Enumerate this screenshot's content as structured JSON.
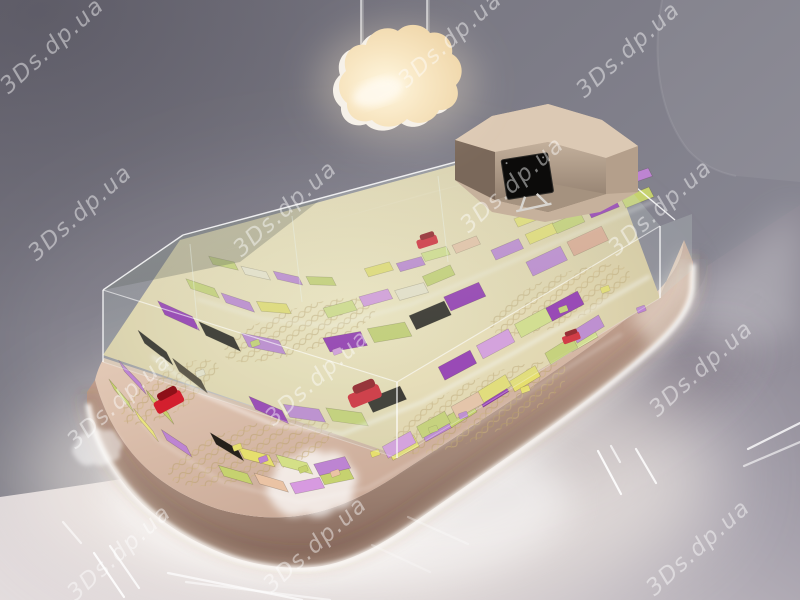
{
  "scene": {
    "kind": "3d-render-retail-island-display-kiosk",
    "watermark": {
      "text": "3Ds.dp.ua",
      "angle": -42,
      "positions": [
        [
          57,
          51
        ],
        [
          455,
          45
        ],
        [
          633,
          55
        ],
        [
          85,
          218
        ],
        [
          290,
          214
        ],
        [
          517,
          190
        ],
        [
          665,
          213
        ],
        [
          124,
          406
        ],
        [
          322,
          383
        ],
        [
          706,
          374
        ],
        [
          124,
          558
        ],
        [
          320,
          550
        ],
        [
          703,
          553
        ]
      ]
    },
    "colors": {
      "wall_dark": "#716f7a",
      "wall_light": "#8f8e9a",
      "floor_light": "#e3dcdd",
      "floor_dark": "#8b8793",
      "floor_glow": "#fff8ef",
      "base_light": "#d3b19e",
      "base_dark": "#87695c",
      "base_top": "#e8d2c0",
      "led_strip": "#ffffff",
      "glass_edge": "rgba(255,255,255,0.8)",
      "interior_glow": "#f6ecc4",
      "lattice_gold": "#cdb47c",
      "lamp_face": "#f2dcb6",
      "lamp_rim": "#f6f1e9",
      "monitor_screen": "#0c0b0a",
      "cloud_logo": "#ffffff",
      "watermark_color": "rgba(255,255,255,0.45)",
      "accent_red": "#d31f2e",
      "accent_red_dark": "#8e1018"
    },
    "lamp": {
      "icon": "cloud-pendant-lamp",
      "rod_count": 2
    },
    "logo": {
      "icon": "cloud-logo"
    },
    "cashier": {
      "monitor": "black-lcd-monitor"
    },
    "display": {
      "palette": {
        "lime": "#c6d26f",
        "lime2": "#d4e087",
        "yellow": "#e6df6e",
        "violet": "#bd84d2",
        "magenta": "#d79ae0",
        "purple": "#9130b2",
        "pink": "#eac3a4",
        "salmon": "#dfa88e",
        "black": "#26211b",
        "brown": "#473b2d",
        "cream": "#ece5cc"
      },
      "bands": [
        {
          "w": 30,
          "d": 13,
          "path": [
            [
              116,
              390
            ],
            [
              152,
              432
            ],
            [
              212,
              472
            ],
            [
              288,
              494
            ],
            [
              356,
              480
            ],
            [
              448,
              430
            ],
            [
              542,
              372
            ],
            [
              618,
              328
            ]
          ],
          "colors": [
            "lime",
            "yellow",
            "violet",
            null,
            "lime",
            "pink",
            "magenta",
            "lime",
            null,
            "yellow",
            "violet",
            "lime",
            "purple",
            "yellow",
            null,
            "lime2",
            "violet"
          ]
        },
        {
          "w": 32,
          "d": 14,
          "path": [
            [
              126,
              372
            ],
            [
              166,
              414
            ],
            [
              236,
              456
            ],
            [
              312,
              476
            ],
            [
              386,
              458
            ],
            [
              476,
              408
            ],
            [
              566,
              352
            ],
            [
              634,
              310
            ]
          ],
          "colors": [
            "violet",
            "lime",
            null,
            "black",
            "yellow",
            "lime2",
            "violet",
            null,
            "magenta",
            "lime",
            "pink",
            "yellow",
            null,
            "lime",
            "violet",
            "lime"
          ]
        },
        {
          "w": 36,
          "d": 16,
          "path": [
            [
              146,
              344
            ],
            [
              198,
              384
            ],
            [
              268,
              414
            ],
            [
              340,
              424
            ],
            [
              420,
              392
            ],
            [
              510,
              344
            ],
            [
              592,
              300
            ],
            [
              650,
              268
            ]
          ],
          "colors": [
            "black",
            "brown",
            null,
            "purple",
            "violet",
            "lime",
            "black",
            null,
            "purple",
            "magenta",
            "lime2",
            "purple",
            null,
            "black",
            "violet"
          ]
        },
        {
          "w": 38,
          "d": 17,
          "path": [
            [
              166,
              316
            ],
            [
              228,
              344
            ],
            [
              298,
              358
            ],
            [
              378,
              344
            ],
            [
              468,
              306
            ],
            [
              558,
              264
            ],
            [
              636,
              228
            ]
          ],
          "colors": [
            "purple",
            "black",
            "violet",
            null,
            "purple",
            "lime",
            "black",
            "purple",
            null,
            "violet",
            "salmon",
            "black",
            null,
            "purple"
          ]
        },
        {
          "w": 30,
          "d": 12,
          "path": [
            [
              192,
              290
            ],
            [
              258,
              312
            ],
            [
              330,
              318
            ],
            [
              410,
              296
            ],
            [
              500,
              258
            ],
            [
              584,
              222
            ],
            [
              654,
              194
            ]
          ],
          "colors": [
            "lime",
            "violet",
            "yellow",
            null,
            "lime2",
            "magenta",
            "cream",
            "lime",
            null,
            "violet",
            "yellow",
            "lime",
            "purple"
          ]
        },
        {
          "w": 26,
          "d": 10,
          "path": [
            [
              214,
              266
            ],
            [
              284,
              282
            ],
            [
              350,
              284
            ],
            [
              430,
              262
            ],
            [
              518,
              228
            ],
            [
              598,
              196
            ],
            [
              656,
              176
            ]
          ],
          "colors": [
            "lime",
            "cream",
            "violet",
            "lime",
            null,
            "yellow",
            "violet",
            "lime2",
            "pink",
            null,
            "yellow",
            "lime"
          ]
        }
      ],
      "chocolates": [
        [
          232,
          446,
          "yellow"
        ],
        [
          258,
          458,
          "violet"
        ],
        [
          298,
          468,
          "lime"
        ],
        [
          330,
          472,
          "pink"
        ],
        [
          428,
          428,
          "lime"
        ],
        [
          458,
          414,
          "violet"
        ],
        [
          520,
          388,
          "yellow"
        ],
        [
          250,
          342,
          "lime"
        ],
        [
          332,
          350,
          "magenta"
        ],
        [
          558,
          308,
          "lime"
        ],
        [
          600,
          288,
          "yellow"
        ],
        [
          636,
          308,
          "violet"
        ],
        [
          195,
          372,
          "cream"
        ],
        [
          370,
          452,
          "yellow"
        ]
      ],
      "red_accents": [
        {
          "x": 170,
          "y": 402,
          "r": -28,
          "s": 1
        },
        {
          "x": 366,
          "y": 396,
          "r": -22,
          "s": 1.1
        },
        {
          "x": 428,
          "y": 242,
          "r": -18,
          "s": 0.7
        },
        {
          "x": 572,
          "y": 338,
          "r": -20,
          "s": 0.6
        }
      ]
    },
    "floor_dashes": [
      [
        94,
        553,
        124,
        597,
        0.9
      ],
      [
        110,
        546,
        139,
        588,
        0.8
      ],
      [
        63,
        522,
        81,
        543,
        0.6
      ],
      [
        168,
        573,
        302,
        600,
        0.7
      ],
      [
        186,
        582,
        330,
        600,
        0.55
      ],
      [
        598,
        451,
        621,
        494,
        0.9
      ],
      [
        636,
        449,
        656,
        483,
        0.85
      ],
      [
        611,
        446,
        620,
        462,
        0.7
      ],
      [
        748,
        449,
        800,
        423,
        0.8
      ],
      [
        744,
        466,
        800,
        442,
        0.6
      ],
      [
        408,
        517,
        468,
        544,
        0.3
      ],
      [
        372,
        545,
        430,
        572,
        0.25
      ]
    ]
  }
}
